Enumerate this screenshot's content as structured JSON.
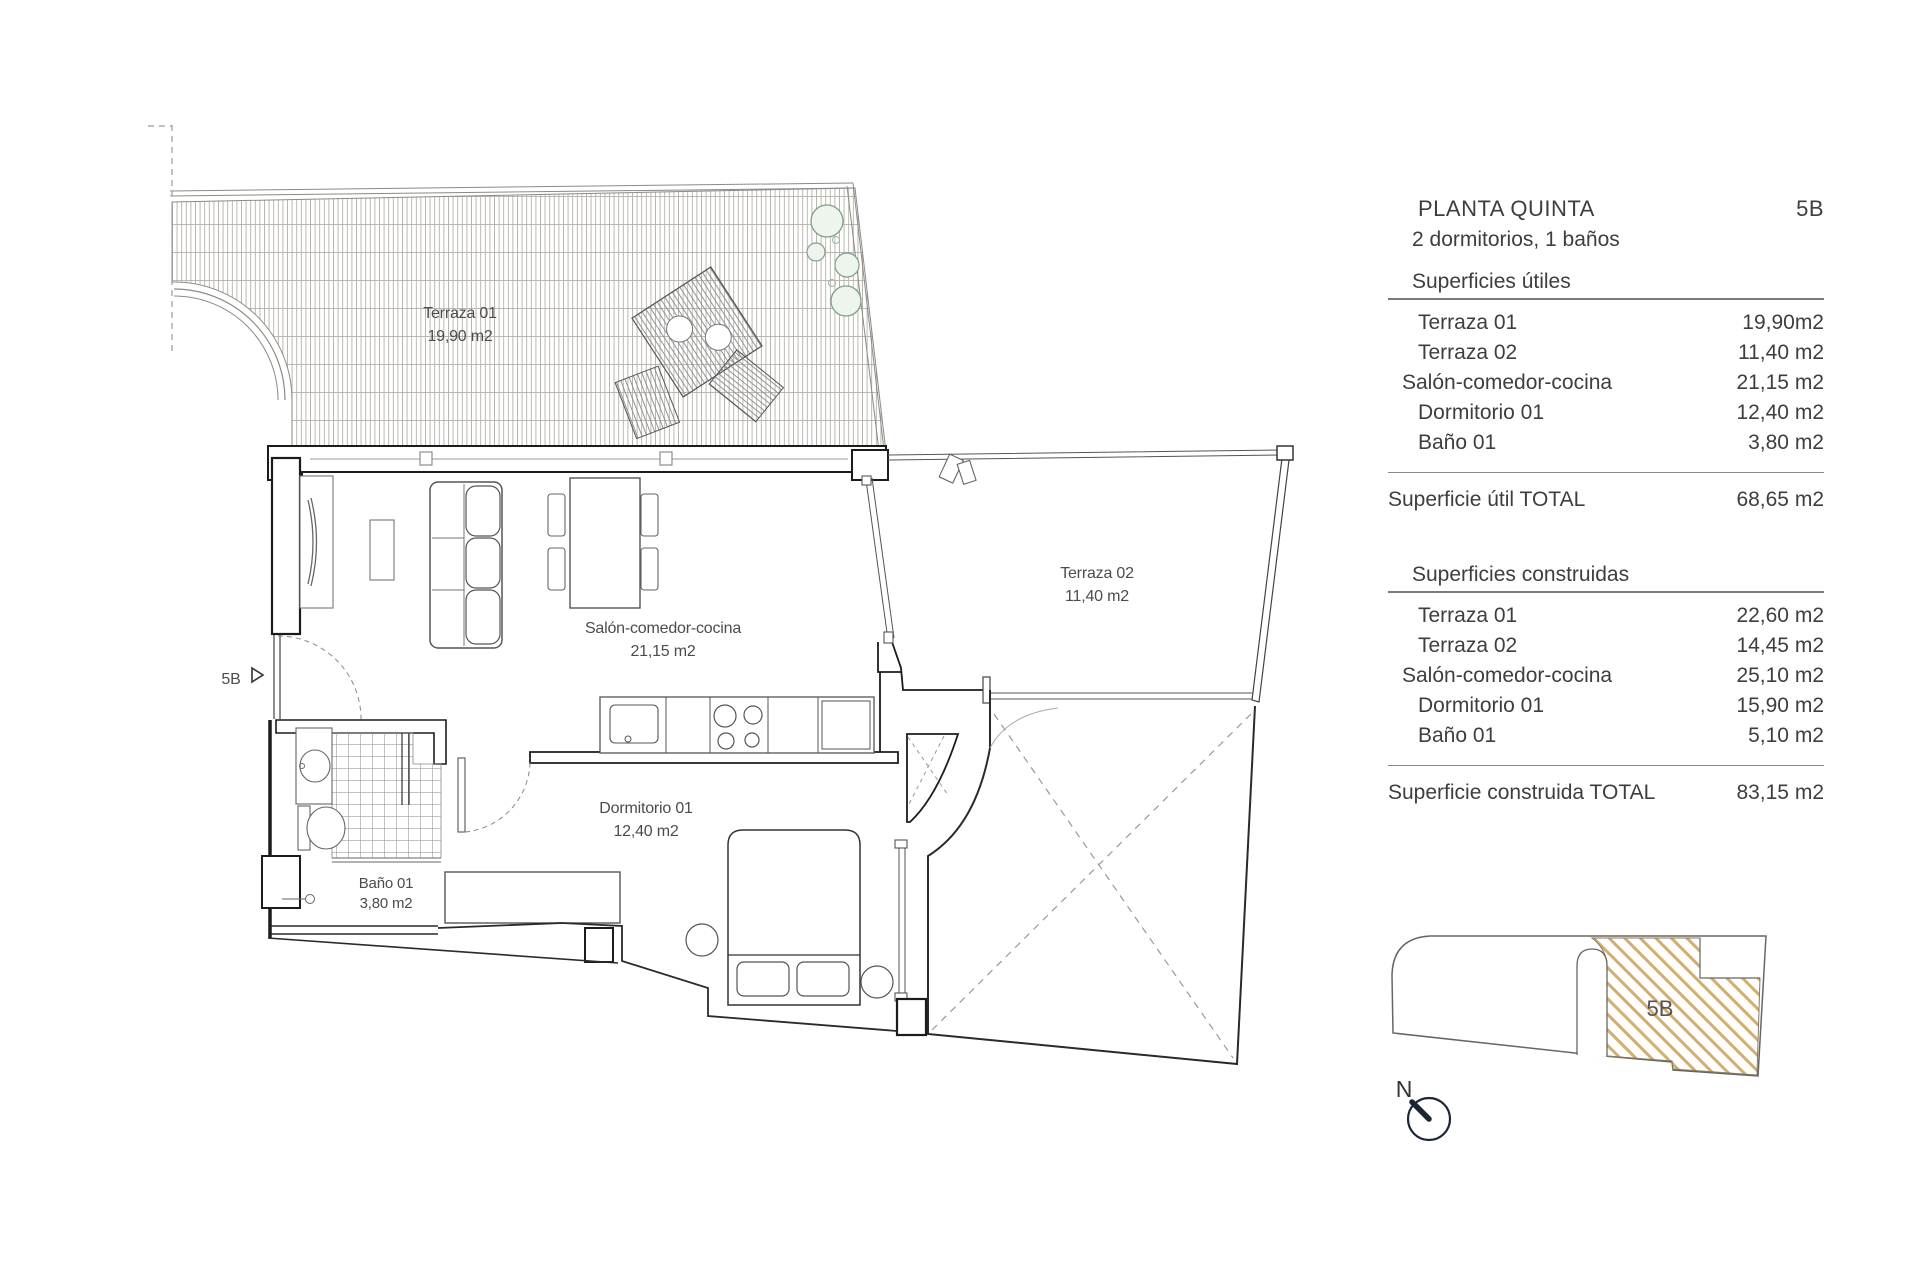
{
  "plan": {
    "entrance_marker": "5B",
    "labels": {
      "terraza01": {
        "name": "Terraza 01",
        "area": "19,90 m2"
      },
      "terraza02": {
        "name": "Terraza 02",
        "area": "11,40 m2"
      },
      "salon": {
        "name": "Salón-comedor-cocina",
        "area": "21,15 m2"
      },
      "dormitorio": {
        "name": "Dormitorio 01",
        "area": "12,40 m2"
      },
      "bano": {
        "name": "Baño 01",
        "area": "3,80 m2"
      }
    }
  },
  "panel": {
    "title": "PLANTA QUINTA",
    "unit": "5B",
    "subtitle": "2 dormitorios, 1 baños",
    "superficies_utiles": {
      "heading": "Superficies útiles",
      "rows": [
        {
          "name": "Terraza 01",
          "value": "19,90m2"
        },
        {
          "name": "Terraza 02",
          "value": "11,40 m2"
        },
        {
          "name": "Salón-comedor-cocina",
          "value": "21,15 m2"
        },
        {
          "name": "Dormitorio 01",
          "value": "12,40 m2"
        },
        {
          "name": "Baño 01",
          "value": "3,80 m2"
        }
      ],
      "total_label": "Superficie útil TOTAL",
      "total_value": "68,65 m2"
    },
    "superficies_construidas": {
      "heading": "Superficies construidas",
      "rows": [
        {
          "name": "Terraza 01",
          "value": "22,60 m2"
        },
        {
          "name": "Terraza 02",
          "value": "14,45 m2"
        },
        {
          "name": "Salón-comedor-cocina",
          "value": "25,10 m2"
        },
        {
          "name": "Dormitorio 01",
          "value": "15,90 m2"
        },
        {
          "name": "Baño 01",
          "value": "5,10 m2"
        }
      ],
      "total_label": "Superficie construida TOTAL",
      "total_value": "83,15 m2"
    }
  },
  "locator": {
    "unit_label": "5B"
  },
  "north": {
    "label": "N"
  },
  "colors": {
    "hatch_gold": "#d3ae6e",
    "deck_line": "#a09a8e",
    "tree_green": "#7d9f83",
    "wall": "#1c1c1c",
    "text": "#3e3e3e"
  }
}
